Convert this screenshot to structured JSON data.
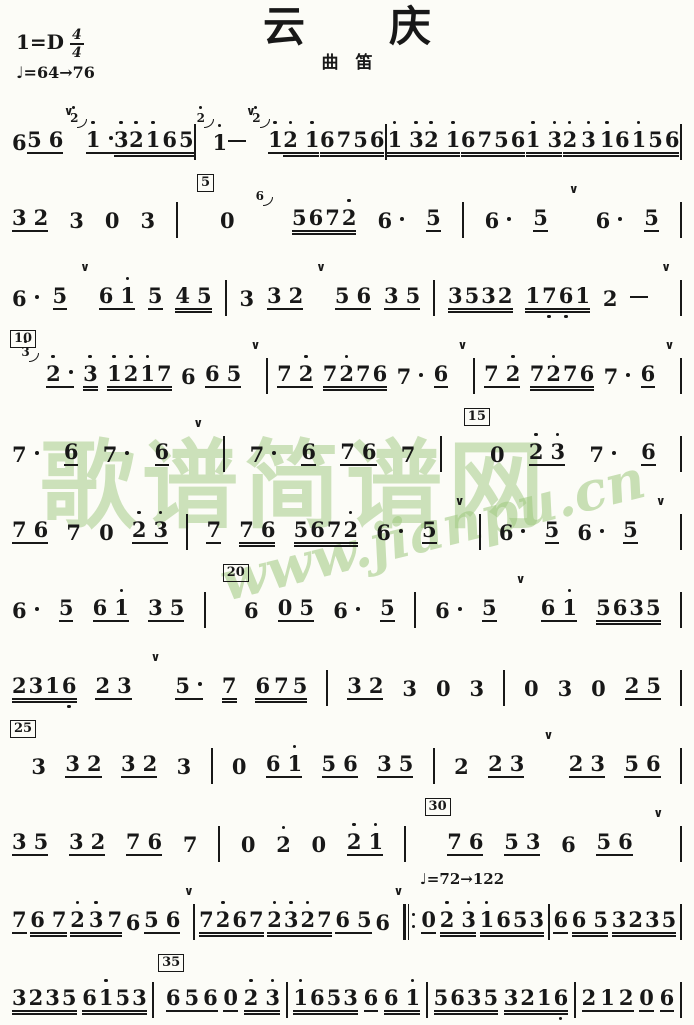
{
  "header": {
    "key": "1=D",
    "time_top": "4",
    "time_bottom": "4",
    "tempo": "♩=64→76",
    "title": "云　　庆",
    "instrument": "曲　笛"
  },
  "watermark": {
    "text": "歌谱简谱网",
    "url": "www.jianpu.cn",
    "color": "#9ec87e"
  },
  "icons": {
    "breath_mark": "∨"
  },
  "notation": {
    "tempo_change": "♩=72→122",
    "lines": [
      [
        [
          "n",
          "6",
          0
        ],
        [
          "n",
          "56",
          1
        ],
        [
          "v"
        ],
        [
          "g",
          "2'"
        ],
        [
          "n",
          "1'.",
          1
        ],
        [
          "n",
          "3'",
          2
        ],
        [
          "n",
          "2'1'65",
          2
        ],
        [
          "b"
        ],
        [
          "g",
          "2'"
        ],
        [
          "n",
          "1'",
          0
        ],
        [
          "d"
        ],
        [
          "v"
        ],
        [
          "g",
          "2'"
        ],
        [
          "n",
          "1'",
          1
        ],
        [
          "n",
          "2'1'",
          2
        ],
        [
          "n",
          "6756",
          2
        ],
        [
          "b"
        ],
        [
          "n",
          "1'3'",
          2
        ],
        [
          "n",
          "2'1'",
          2
        ],
        [
          "n",
          "6756",
          2
        ],
        [
          "n",
          "1'3'",
          2
        ],
        [
          "n",
          "2'3'1'",
          2
        ],
        [
          "n",
          "61'56",
          2
        ],
        [
          "b"
        ]
      ],
      [
        [
          "n",
          "32",
          1
        ],
        [
          "n",
          "3",
          0
        ],
        [
          "n",
          "0",
          0
        ],
        [
          "n",
          "3",
          0
        ],
        [
          "b"
        ],
        [
          "m",
          "5"
        ],
        [
          "n",
          "0",
          0
        ],
        [
          "g",
          "6"
        ],
        [
          "n",
          "5672'",
          2
        ],
        [
          "n",
          "6.",
          0
        ],
        [
          "n",
          "5",
          1
        ],
        [
          "b"
        ],
        [
          "n",
          "6.",
          0
        ],
        [
          "n",
          "5",
          1
        ],
        [
          "v"
        ],
        [
          "n",
          "6.",
          0
        ],
        [
          "n",
          "5",
          1
        ],
        [
          "b"
        ]
      ],
      [
        [
          "n",
          "6.",
          0
        ],
        [
          "n",
          "5",
          1
        ],
        [
          "v"
        ],
        [
          "n",
          "61'",
          1
        ],
        [
          "n",
          "5",
          1
        ],
        [
          "n",
          "45",
          2
        ],
        [
          "b"
        ],
        [
          "n",
          "3",
          0
        ],
        [
          "n",
          "32",
          1
        ],
        [
          "v"
        ],
        [
          "n",
          "56",
          1
        ],
        [
          "n",
          "35",
          1
        ],
        [
          "b"
        ],
        [
          "n",
          "3532",
          2
        ],
        [
          "n",
          "17,6,1",
          2
        ],
        [
          "n",
          "2",
          0
        ],
        [
          "d"
        ],
        [
          "v"
        ],
        [
          "b"
        ]
      ],
      [
        [
          "m",
          "10"
        ],
        [
          "g",
          "3'"
        ],
        [
          "n",
          "2'.",
          1
        ],
        [
          "n",
          "3'",
          2
        ],
        [
          "n",
          "1'2'1'7",
          2
        ],
        [
          "n",
          "6",
          0
        ],
        [
          "n",
          "65",
          1
        ],
        [
          "v"
        ],
        [
          "b"
        ],
        [
          "n",
          "72'",
          1
        ],
        [
          "n",
          "72'76",
          2
        ],
        [
          "n",
          "7.",
          0
        ],
        [
          "n",
          "6",
          1
        ],
        [
          "v"
        ],
        [
          "b"
        ],
        [
          "n",
          "72'",
          1
        ],
        [
          "n",
          "72'76",
          2
        ],
        [
          "n",
          "7.",
          0
        ],
        [
          "n",
          "6",
          1
        ],
        [
          "v"
        ],
        [
          "b"
        ]
      ],
      [
        [
          "n",
          "7.",
          0
        ],
        [
          "n",
          "6",
          1
        ],
        [
          "n",
          "7.",
          0
        ],
        [
          "n",
          "6",
          1
        ],
        [
          "v"
        ],
        [
          "b"
        ],
        [
          "n",
          "7.",
          0
        ],
        [
          "n",
          "6",
          1
        ],
        [
          "n",
          "76",
          1
        ],
        [
          "n",
          "7",
          0
        ],
        [
          "b"
        ],
        [
          "m",
          "15"
        ],
        [
          "n",
          "0",
          0
        ],
        [
          "n",
          "2'3'",
          1
        ],
        [
          "n",
          "7.",
          0
        ],
        [
          "n",
          "6",
          1
        ],
        [
          "b"
        ]
      ],
      [
        [
          "n",
          "76",
          1
        ],
        [
          "n",
          "7",
          0
        ],
        [
          "n",
          "0",
          0
        ],
        [
          "n",
          "2'3'",
          1
        ],
        [
          "b"
        ],
        [
          "n",
          "7",
          1
        ],
        [
          "n",
          "76",
          2
        ],
        [
          "n",
          "5672'",
          2
        ],
        [
          "n",
          "6.",
          0
        ],
        [
          "n",
          "5",
          1
        ],
        [
          "v"
        ],
        [
          "b"
        ],
        [
          "n",
          "6.",
          0
        ],
        [
          "n",
          "5",
          1
        ],
        [
          "n",
          "6.",
          0
        ],
        [
          "n",
          "5",
          1
        ],
        [
          "v"
        ],
        [
          "b"
        ]
      ],
      [
        [
          "n",
          "6.",
          0
        ],
        [
          "n",
          "5",
          1
        ],
        [
          "n",
          "61'",
          1
        ],
        [
          "n",
          "35",
          1
        ],
        [
          "b"
        ],
        [
          "m",
          "20"
        ],
        [
          "n",
          "6",
          0
        ],
        [
          "n",
          "05",
          1
        ],
        [
          "n",
          "6.",
          0
        ],
        [
          "n",
          "5",
          1
        ],
        [
          "b"
        ],
        [
          "n",
          "6.",
          0
        ],
        [
          "n",
          "5",
          1
        ],
        [
          "v"
        ],
        [
          "n",
          "61'",
          1
        ],
        [
          "n",
          "5635",
          2
        ],
        [
          "b"
        ]
      ],
      [
        [
          "n",
          "2316,",
          2
        ],
        [
          "n",
          "23",
          1
        ],
        [
          "v"
        ],
        [
          "n",
          "5.",
          1
        ],
        [
          "n",
          "7",
          2
        ],
        [
          "n",
          "675",
          2
        ],
        [
          "b"
        ],
        [
          "n",
          "32",
          1
        ],
        [
          "n",
          "3",
          0
        ],
        [
          "n",
          "0",
          0
        ],
        [
          "n",
          "3",
          0
        ],
        [
          "b"
        ],
        [
          "n",
          "0",
          0
        ],
        [
          "n",
          "3",
          0
        ],
        [
          "n",
          "0",
          0
        ],
        [
          "n",
          "25",
          1
        ],
        [
          "b"
        ]
      ],
      [
        [
          "m",
          "25"
        ],
        [
          "n",
          "3",
          0
        ],
        [
          "n",
          "32",
          1
        ],
        [
          "n",
          "32",
          1
        ],
        [
          "n",
          "3",
          0
        ],
        [
          "b"
        ],
        [
          "n",
          "0",
          0
        ],
        [
          "n",
          "61'",
          1
        ],
        [
          "n",
          "56",
          1
        ],
        [
          "n",
          "35",
          1
        ],
        [
          "b"
        ],
        [
          "n",
          "2",
          0
        ],
        [
          "n",
          "23",
          1
        ],
        [
          "v"
        ],
        [
          "n",
          "23",
          1
        ],
        [
          "n",
          "56",
          1
        ],
        [
          "b"
        ]
      ],
      [
        [
          "n",
          "35",
          1
        ],
        [
          "n",
          "32",
          1
        ],
        [
          "n",
          "76",
          1
        ],
        [
          "n",
          "7",
          0
        ],
        [
          "b"
        ],
        [
          "n",
          "0",
          0
        ],
        [
          "n",
          "2'",
          0
        ],
        [
          "n",
          "0",
          0
        ],
        [
          "n",
          "2'1'",
          1
        ],
        [
          "b"
        ],
        [
          "m",
          "30"
        ],
        [
          "n",
          "76",
          1
        ],
        [
          "n",
          "53",
          1
        ],
        [
          "n",
          "6",
          0
        ],
        [
          "n",
          "56",
          1
        ],
        [
          "v"
        ],
        [
          "b"
        ]
      ],
      [
        [
          "n",
          "7",
          1
        ],
        [
          "n",
          "67",
          2
        ],
        [
          "n",
          "2'3'7",
          2
        ],
        [
          "n",
          "6",
          0
        ],
        [
          "n",
          "56",
          1
        ],
        [
          "v"
        ],
        [
          "b"
        ],
        [
          "n",
          "72'67",
          2
        ],
        [
          "n",
          "2'3'2'7",
          2
        ],
        [
          "n",
          "65",
          1
        ],
        [
          "n",
          "6",
          0
        ],
        [
          "v"
        ],
        [
          "rb"
        ],
        [
          "tm",
          "♩=72→122"
        ],
        [
          "n",
          "0",
          1
        ],
        [
          "n",
          "2'3'",
          2
        ],
        [
          "n",
          "1'653",
          2
        ],
        [
          "b"
        ],
        [
          "n",
          "6",
          1
        ],
        [
          "n",
          "65",
          2
        ],
        [
          "n",
          "3235",
          2
        ],
        [
          "b"
        ]
      ],
      [
        [
          "n",
          "3235",
          2
        ],
        [
          "n",
          "61'53",
          2
        ],
        [
          "b"
        ],
        [
          "m",
          "35"
        ],
        [
          "n",
          "656",
          1
        ],
        [
          "n",
          "0",
          1
        ],
        [
          "n",
          "2'3'",
          2
        ],
        [
          "b"
        ],
        [
          "n",
          "1'653",
          2
        ],
        [
          "n",
          "6",
          1
        ],
        [
          "n",
          "61'",
          2
        ],
        [
          "b"
        ],
        [
          "n",
          "5635",
          2
        ],
        [
          "n",
          "3216,",
          2
        ],
        [
          "b"
        ],
        [
          "n",
          "212",
          1
        ],
        [
          "n",
          "0",
          1
        ],
        [
          "n",
          "6",
          1
        ],
        [
          "b"
        ]
      ]
    ]
  }
}
